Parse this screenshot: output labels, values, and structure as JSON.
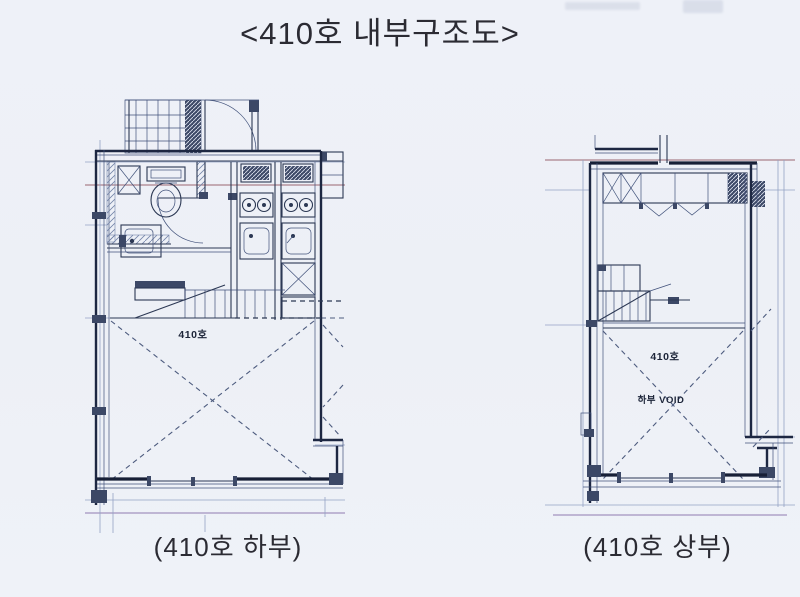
{
  "page": {
    "title": "<410호 내부구조도>",
    "paper_color": "#eef1f7",
    "ink_color": "#2c3854"
  },
  "plans": {
    "lower": {
      "caption": "(410호 하부)",
      "room_label": "410호"
    },
    "upper": {
      "caption": "(410호 상부)",
      "room_label": "410호",
      "void_label": "하부 VOID"
    }
  }
}
